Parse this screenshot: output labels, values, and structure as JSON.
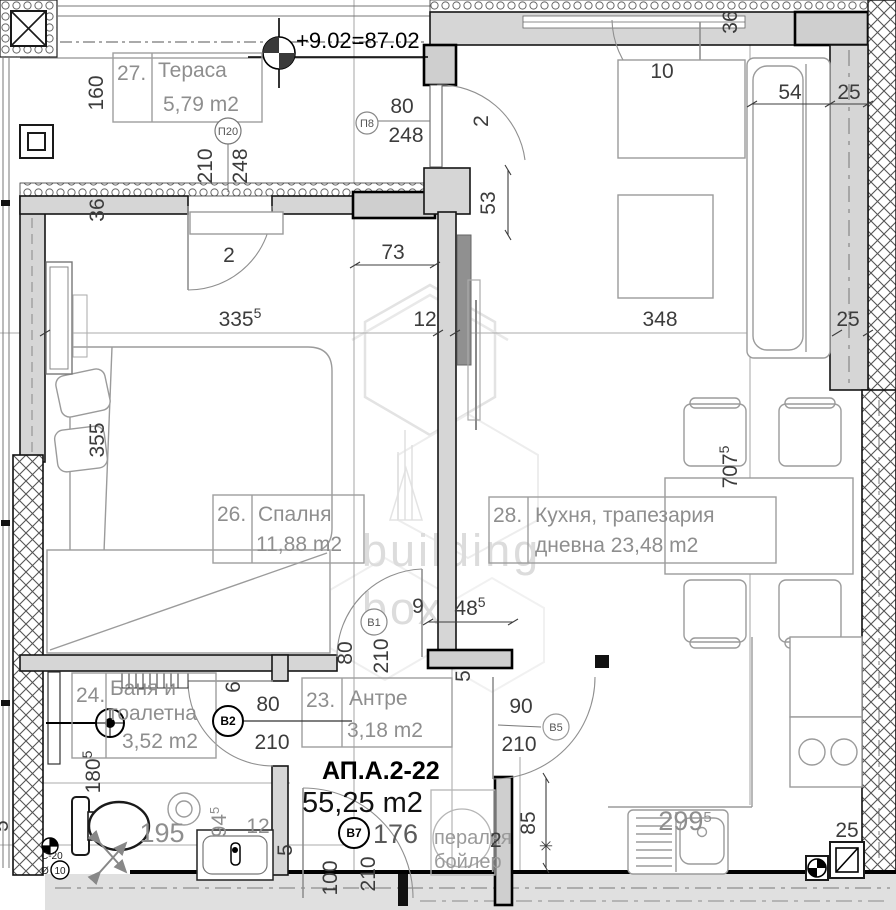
{
  "watermark": {
    "line1": "building",
    "line2": "box"
  },
  "elevation_mark": "+9.02=87.02",
  "apartment": {
    "id": "АП.А.2-22",
    "area": "55,25 m2"
  },
  "rooms": {
    "terrace": {
      "num": "27.",
      "name": "Тераса",
      "area": "5,79 m2"
    },
    "bedroom": {
      "num": "26.",
      "name": "Спалня",
      "area": "11,88 m2"
    },
    "kitchen": {
      "num": "28.",
      "line1": "Кухня, трапезария",
      "line2": "дневна 23,48 m2"
    },
    "bathroom": {
      "num": "24.",
      "line1": "Баня и",
      "line2": "тоалетна",
      "area": "3,52 m2"
    },
    "hall": {
      "num": "23.",
      "name": "Антре",
      "area": "3,18 m2"
    }
  },
  "doors": {
    "p20": {
      "tag": "П20",
      "w": "210",
      "h": "248"
    },
    "p8": {
      "tag": "П8",
      "w": "80",
      "h": "248"
    },
    "v1": {
      "tag": "В1",
      "w": "80",
      "h": "210"
    },
    "v2": {
      "tag": "В2",
      "w": "80",
      "h": "210"
    },
    "v5": {
      "tag": "В5",
      "w": "90",
      "h": "210"
    },
    "v7": {
      "tag": "В7",
      "w": "100",
      "h": "210"
    }
  },
  "labels": {
    "washer": "пералня",
    "boiler": "бойлер",
    "washer_2": "2",
    "pipe": "С-20",
    "pipe_dia": "Ø",
    "pipe_num": "10",
    "asterisk": "✳"
  },
  "dims": {
    "terrace_height": "160",
    "wall_left": "36",
    "wall_top_right": "36",
    "door_terrace": "2",
    "door_entrance": "2",
    "door_kitchen": "10",
    "sofa_54": "54",
    "wall_25_top": "25",
    "seg_53": "53",
    "seg_73": "73",
    "wall_12": "12",
    "bedroom_w": "335",
    "bedroom_w_sup": "5",
    "kitchen_w": "348",
    "wall_25_right": "25",
    "bedroom_l": "355",
    "kitchen_l": "707",
    "kitchen_l_sup": "5",
    "seg_9": "9",
    "seg_48": "48",
    "seg_48_sup": "5",
    "seg_6": "6",
    "bath_l": "180",
    "bath_l_sup": "5",
    "bath_195": "195",
    "basin_94": "94",
    "basin_94_sup": "5",
    "basin_12": "12",
    "hall_176": "176",
    "niche_85": "85",
    "counter_299": "299",
    "counter_299_sup": "5",
    "wall_25_bottom": "25",
    "five_a": "5",
    "five_b": "5",
    "five_c": "5"
  },
  "colors": {
    "wall_fill": "#d6d6d6",
    "line": "#111111",
    "furniture": "#9b9b9b",
    "room_text": "#8e8e8e",
    "dim_text": "#3c3c3c",
    "watermark": "#dcdcdc"
  }
}
